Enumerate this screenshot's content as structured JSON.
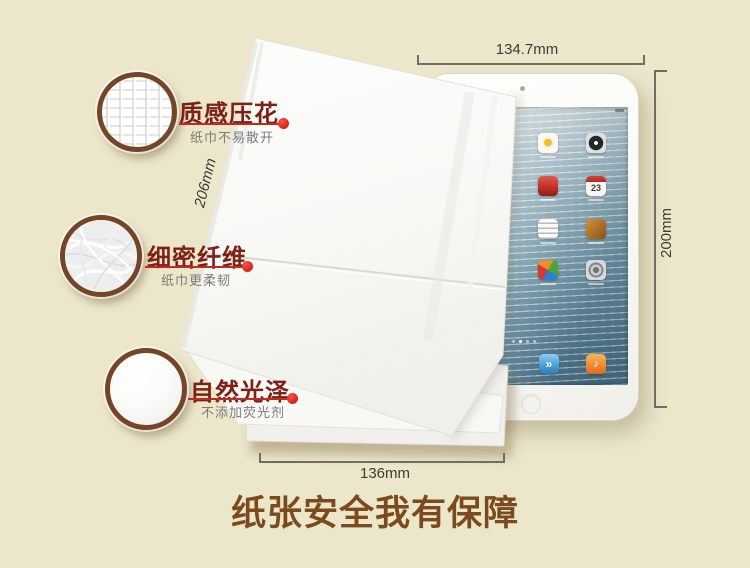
{
  "scene": {
    "footer_title": "纸张安全我有保障"
  },
  "features": [
    {
      "title": "质感压花",
      "subtitle": "纸巾不易散开"
    },
    {
      "title": "细密纤维",
      "subtitle": "纸巾更柔韧"
    },
    {
      "title": "自然光泽",
      "subtitle": "不添加荧光剂"
    }
  ],
  "dimensions": {
    "ipad_width": "134.7mm",
    "ipad_height": "200mm",
    "tissue_height": "206mm",
    "tissue_width": "136mm"
  },
  "ipad": {
    "calendar_day": "23",
    "dock_videos_glyph": "»",
    "dock_music_glyph": "♪",
    "app_icons": [
      "photos",
      "clock",
      "videos",
      "calendar",
      "notes",
      "photo-booth",
      "game-center",
      "settings"
    ],
    "dock_icons": [
      "videos",
      "music"
    ]
  },
  "colors": {
    "background": "#ece6cb",
    "accent_red": "#df2b1e",
    "feature_title": "#7d2016",
    "feature_subtitle": "#7c7c78",
    "footer_brown": "#7b4a1d",
    "dimension_line": "#6e6e66",
    "badge_ring_brown": "#744526"
  }
}
